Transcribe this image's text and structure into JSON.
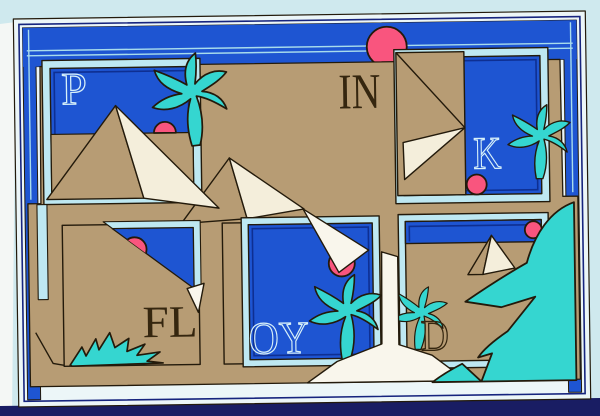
{
  "artwork": {
    "description": "surreal desert postcard illustration with pyramids, palms and framed windows",
    "letters": {
      "p": "P",
      "in": "IN",
      "k": "K",
      "fl": "FL",
      "oy": "OY",
      "d": "D"
    },
    "colors": {
      "background": "#cfe9ee",
      "background_bottom": "#191d63",
      "background_left": "#f4f7f5",
      "card_margin": "#ecf6f8",
      "pinstripe_navy": "#16247e",
      "card_blue": "#1e55d2",
      "pinstripe_pale": "#a8dcec",
      "desert_tan": "#b79c74",
      "panel_frame_pale": "#bee8f2",
      "panel_pinstripe_navy": "#0e2f92",
      "sun_pink": "#f9557e",
      "palm_cyan": "#35d6d0",
      "pyramid_cream": "#f4eedb",
      "path_white": "#f9f6ec",
      "outline_dark": "#231a0b",
      "letter_pale": "#d8f1f9",
      "letter_dark": "#35260f"
    }
  }
}
